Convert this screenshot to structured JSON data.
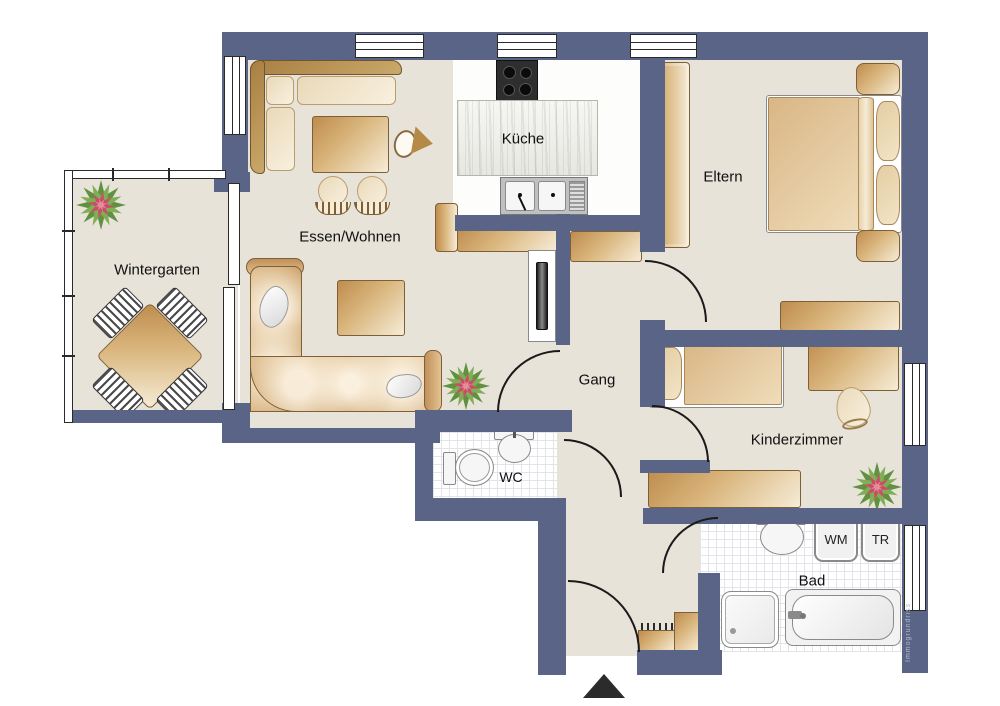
{
  "plan": {
    "rooms": {
      "kueche": "Küche",
      "essen_wohnen": "Essen/Wohnen",
      "wintergarten": "Wintergarten",
      "eltern": "Eltern",
      "gang": "Gang",
      "kinderzimmer": "Kinderzimmer",
      "wc": "WC",
      "bad": "Bad"
    },
    "appliances": {
      "wm": "WM",
      "tr": "TR"
    },
    "watermark": "Immogrundriss",
    "colors": {
      "wall": "#5a6486",
      "floor": "#e8e3d9",
      "furniture": "#bf8c4e",
      "plant_green": "#6d9e4f",
      "plant_red": "#c84f68"
    }
  }
}
